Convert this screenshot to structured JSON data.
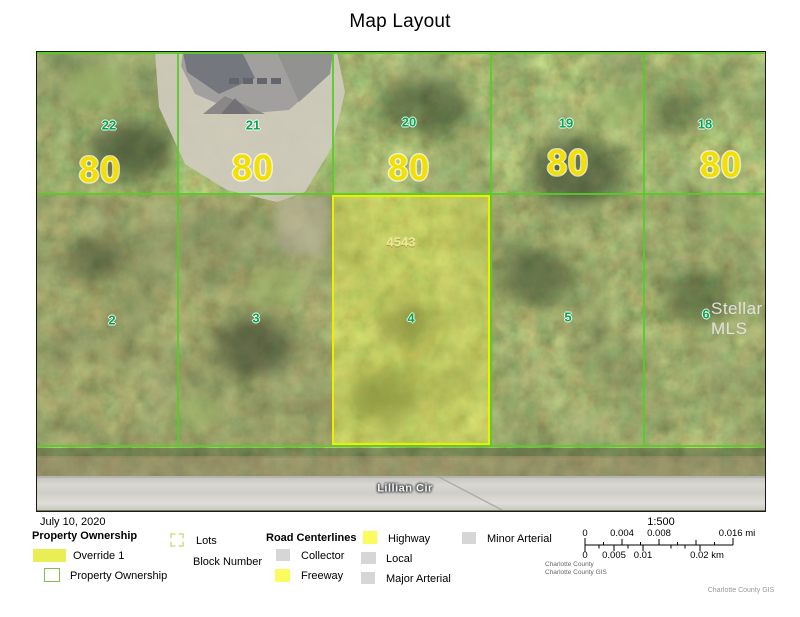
{
  "title": "Map Layout",
  "map": {
    "watermark": "Stellar MLS",
    "road_name": "Lillian Cir",
    "selected_parcel": {
      "parcel_id": "4543",
      "lot": "4"
    },
    "top_lots": [
      {
        "lot": "22",
        "width": "80"
      },
      {
        "lot": "21",
        "width": "80"
      },
      {
        "lot": "20",
        "width": "80"
      },
      {
        "lot": "19",
        "width": "80"
      },
      {
        "lot": "18",
        "width": "80"
      }
    ],
    "bottom_lots": [
      {
        "lot": "2"
      },
      {
        "lot": "3"
      },
      {
        "lot": "4"
      },
      {
        "lot": "5"
      },
      {
        "lot": "6"
      }
    ],
    "colors": {
      "parcel_line": "#55cd25",
      "selected_line": "#f0ee00",
      "selected_fill": "rgba(238,236,70,0.38)",
      "lot_number_green": "#00a651",
      "width_label_yellow": "#f3df00",
      "block_label_yellow": "#f0e98c"
    }
  },
  "legend": {
    "date": "July 10, 2020",
    "ownership_header": "Property Ownership",
    "override_label": "Override 1",
    "ownership_label": "Property Ownership",
    "lots_label": "Lots",
    "block_number_label": "Block Number",
    "roads_header": "Road Centerlines",
    "collector_label": "Collector",
    "freeway_label": "Freeway",
    "highway_label": "Highway",
    "local_label": "Local",
    "major_arterial_label": "Major Arterial",
    "minor_arterial_label": "Minor Arterial",
    "colors": {
      "override_swatch": "#e9ee55",
      "ownership_border": "#83ba52",
      "lots_dash": "#dde4a0",
      "road_gray": "#d6d6d6",
      "road_yellow": "#fbfb5d"
    }
  },
  "scalebar": {
    "ratio": "1:500",
    "mi_labels": [
      "0",
      "0.004",
      "0.008",
      "0.016 mi"
    ],
    "km_labels": [
      "0",
      "0.005",
      "0.01",
      "0.02 km"
    ],
    "credit_line1": "Charlotte County",
    "credit_line2": "Charlotte County GIS",
    "footer_credit": "Charlotte County GIS"
  }
}
